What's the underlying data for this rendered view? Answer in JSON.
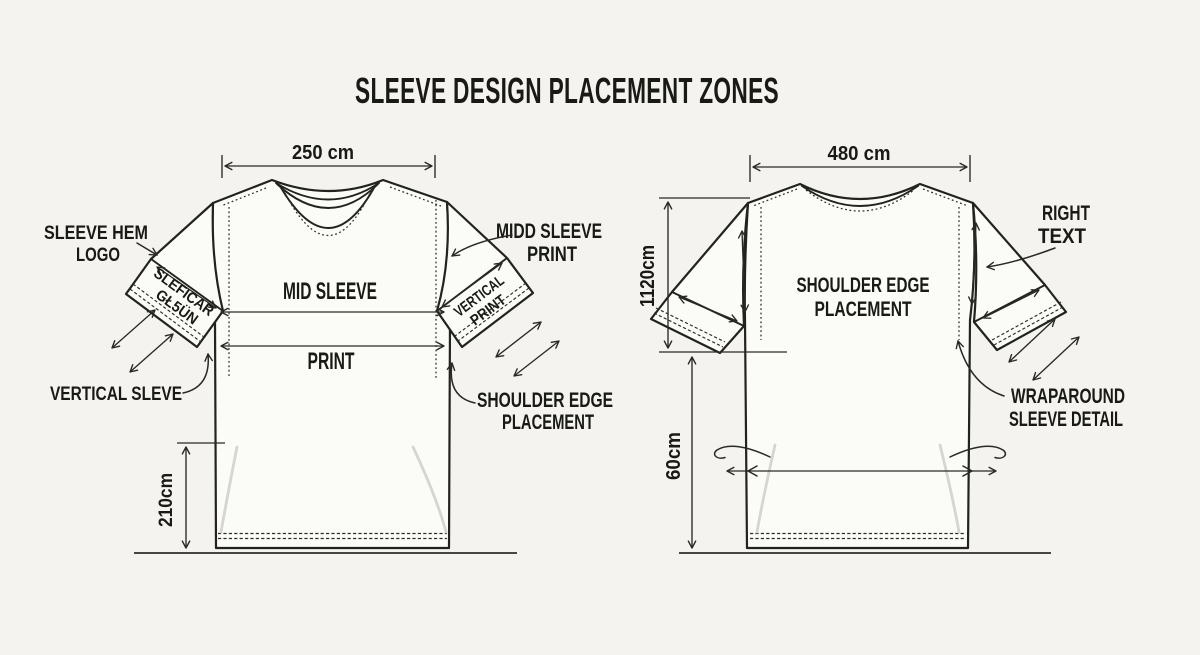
{
  "title": "SLEEVE DESIGN PLACEMENT ZONES",
  "front": {
    "top_width": "250 cm",
    "side_height": "210cm",
    "sleeve_text": {
      "line1": "SLEFICAR",
      "line2": "GŁ5ÜN"
    },
    "cuff_text": {
      "line1": "VERTICAL",
      "line2": "PRINT"
    },
    "labels": {
      "sleeve_hem_logo_1": "SLEEVE HEM",
      "sleeve_hem_logo_2": "LOGO",
      "mid_sleeve": "MID SLEEVE",
      "print": "PRINT",
      "midd_sleeve_print_1": "MIDD SLEEVE",
      "midd_sleeve_print_2": "PRINT",
      "vertical_sleve": "VERTICAL SLEVE",
      "shoulder_edge_1": "SHOULDER EDGE",
      "shoulder_edge_2": "PLACEMENT"
    }
  },
  "back": {
    "top_width": "480 cm",
    "side_height_upper": "1120cm",
    "side_height_lower": "60cm",
    "labels": {
      "shoulder_edge_1": "SHOULDER EDGE",
      "shoulder_edge_2": "PLACEMENT",
      "right_text_1": "RIGHT",
      "right_text_2": "TEXT",
      "wraparound_1": "WRAPAROUND",
      "wraparound_2": "SLEEVE DETAIL"
    }
  },
  "colors": {
    "background": "#f4f3f0",
    "ink": "#22221f",
    "shirt_fill": "#fbfbf8",
    "crease": "#d6d5d0",
    "ground": "#454543"
  }
}
